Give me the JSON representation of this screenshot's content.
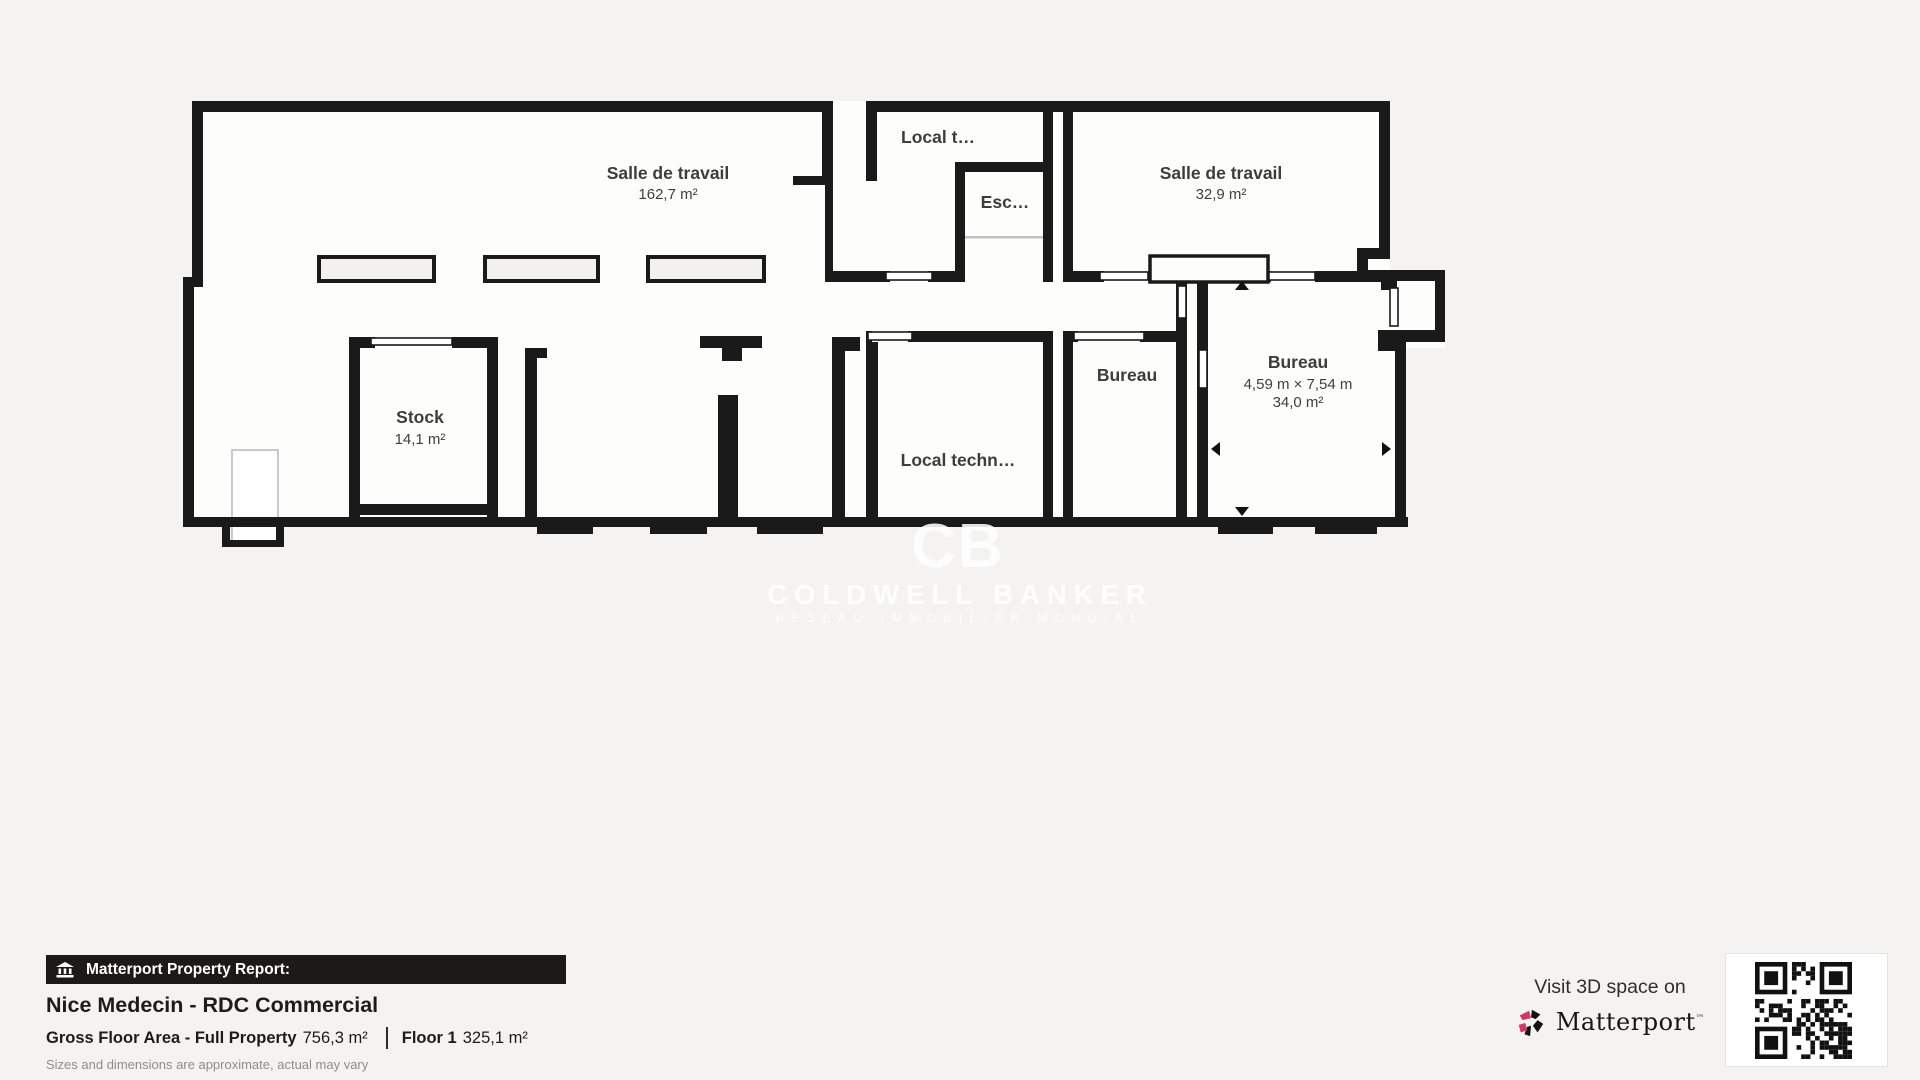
{
  "plan": {
    "rooms": {
      "salle1": {
        "name": "Salle de travail",
        "area": "162,7 m²"
      },
      "local_t": {
        "name": "Local t…"
      },
      "esc": {
        "name": "Esc…"
      },
      "salle2": {
        "name": "Salle de travail",
        "area": "32,9 m²"
      },
      "stock": {
        "name": "Stock",
        "area": "14,1 m²"
      },
      "local_tech": {
        "name": "Local techn…"
      },
      "bureau_small": {
        "name": "Bureau"
      },
      "bureau_right": {
        "name": "Bureau",
        "dims": "4,59 m × 7,54 m",
        "area": "34,0 m²"
      }
    },
    "watermark": {
      "monogram": "CB",
      "line1": "COLDWELL BANKER",
      "line2": "RESEAU IMMOBILIER MONDIAL"
    }
  },
  "footer": {
    "report_label": "Matterport Property Report:",
    "title": "Nice Medecin - RDC Commercial",
    "gfa_label": "Gross Floor Area - Full Property",
    "gfa_value": "756,3 m²",
    "floor_label": "Floor 1",
    "floor_value": "325,1 m²",
    "disclaimer": "Sizes and dimensions are approximate, actual may vary",
    "visit": "Visit 3D space on",
    "brand": "Matterport",
    "brand_tm": "™"
  },
  "colors": {
    "background": "#f4f3f1",
    "room_fill": "#fdfdfc",
    "wall": "#1a1a1a",
    "banner": "#1c1a19",
    "brand_pink": "#cf3a68"
  }
}
